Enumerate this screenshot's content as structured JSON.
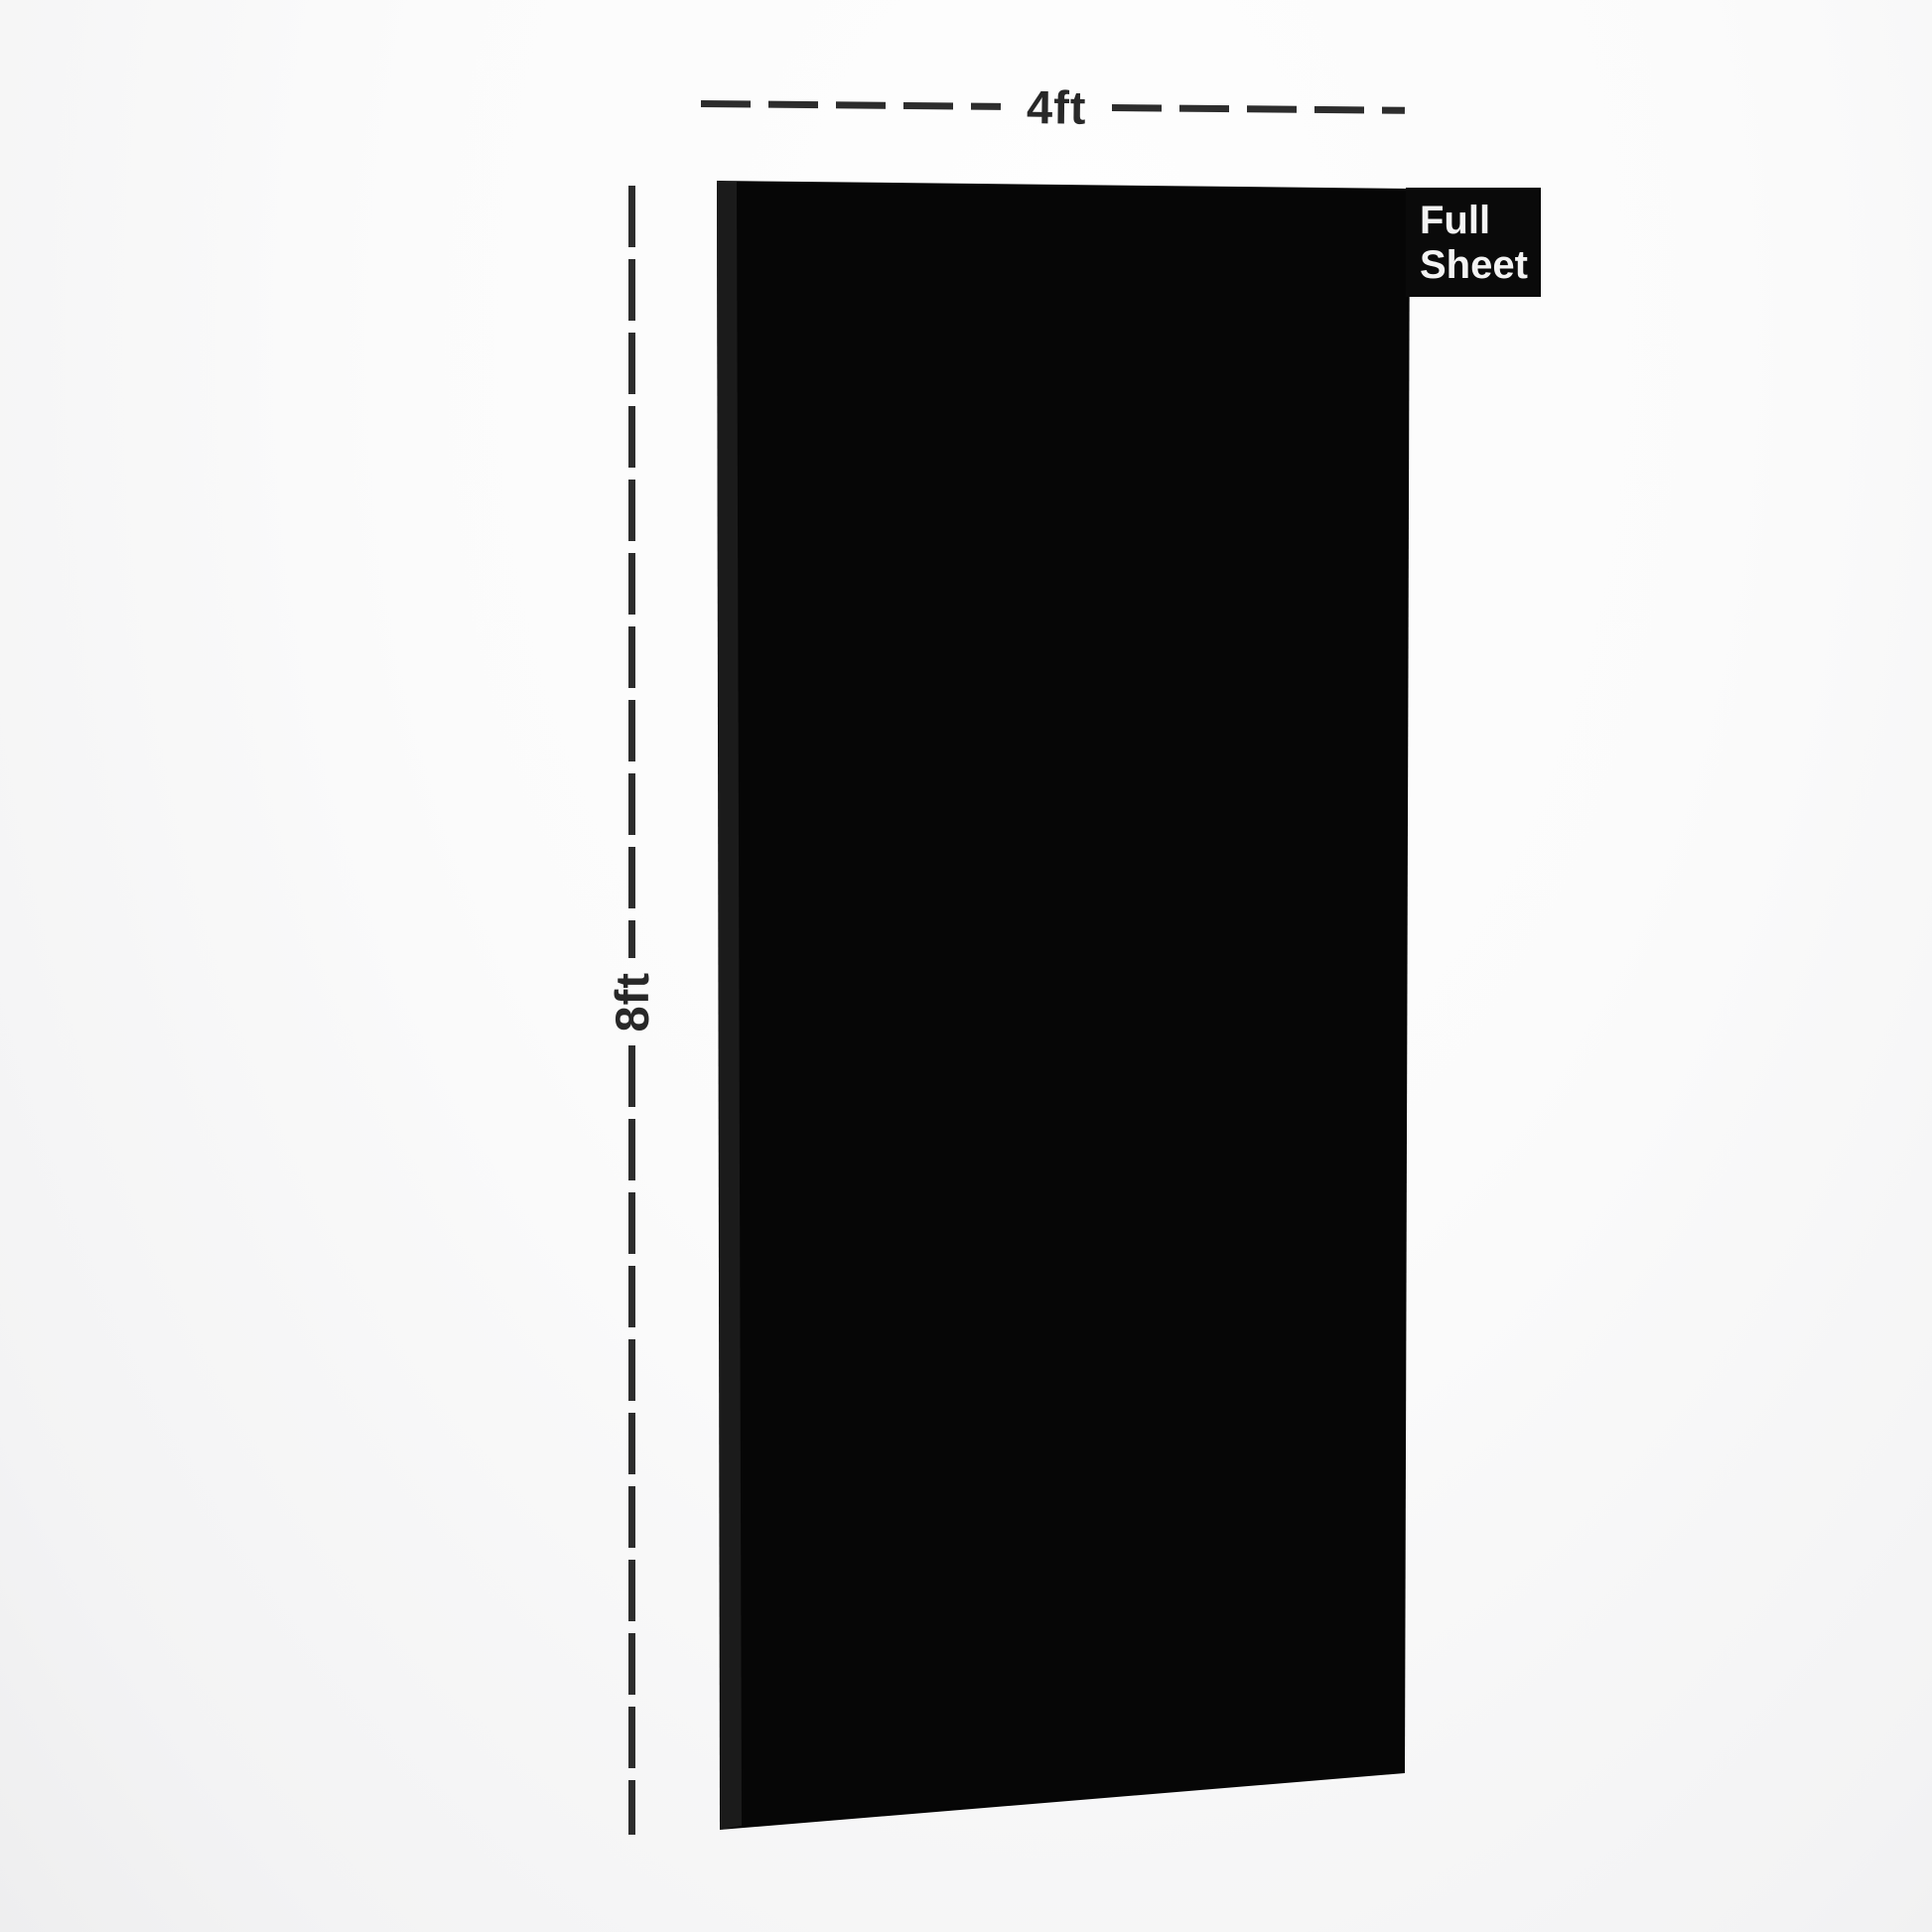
{
  "page": {
    "background_color": "#f7f7f8",
    "description_colors": {
      "dimension_line": "#2d2d2d",
      "dimension_text": "#282828"
    }
  },
  "sheet": {
    "color": "#060606",
    "edge_color": "#1b1b1b",
    "tag": {
      "lines": [
        "Full",
        "Sheet"
      ],
      "bg": "#0a0a0a",
      "text_color": "#f3f3f3"
    }
  },
  "dimensions": {
    "width": {
      "label": "4ft"
    },
    "height": {
      "label": "8ft"
    }
  }
}
